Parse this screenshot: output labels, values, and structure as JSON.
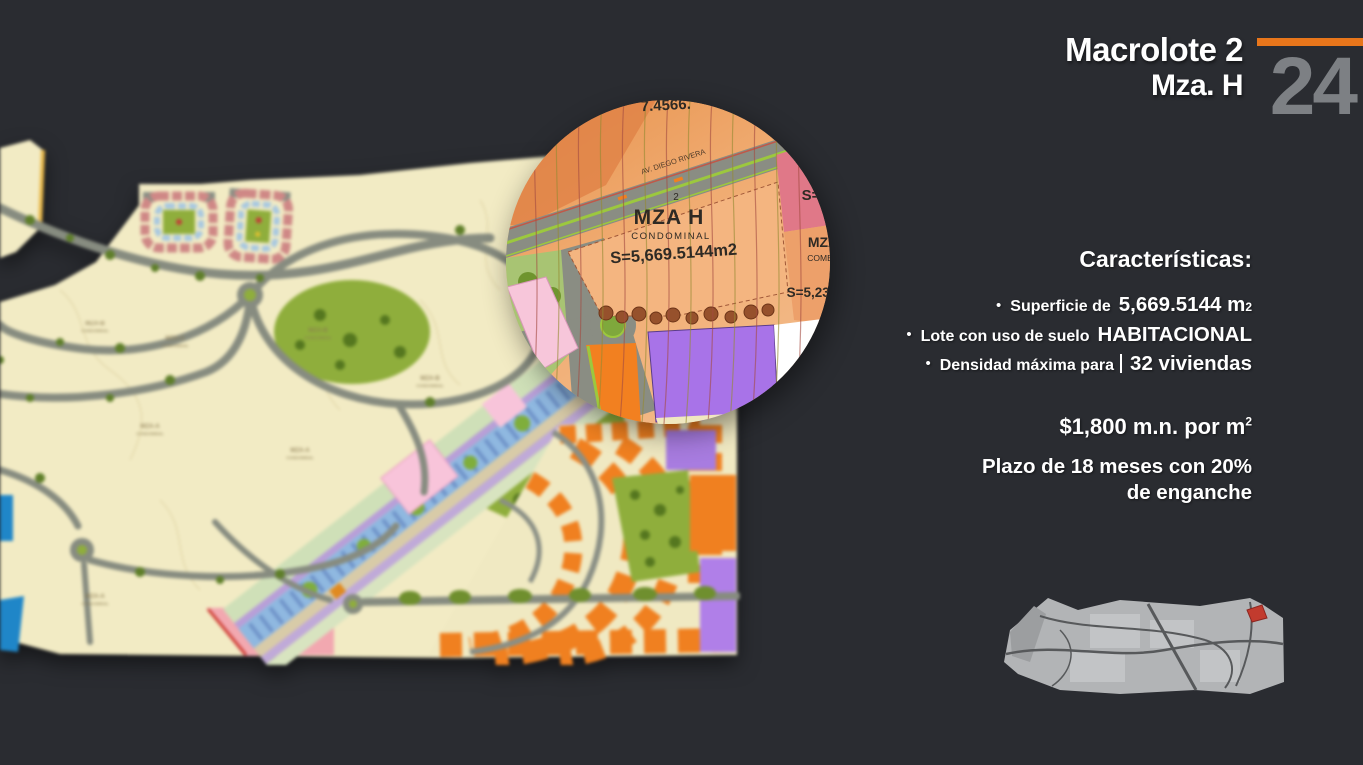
{
  "slide": {
    "background_color": "#2a2c31",
    "accent_color": "#e8761b",
    "page_number_color": "#7d8084",
    "title_line1": "Macrolote 2",
    "title_line2": "Mza. H",
    "page_number": "24"
  },
  "characteristics": {
    "heading": "Características:",
    "bullet_marker": "•",
    "bullets": [
      {
        "prefix": "Superficie de",
        "value": "5,669.5144 m",
        "value_sup": "2"
      },
      {
        "prefix": "Lote con uso de suelo",
        "value": "HABITACIONAL"
      },
      {
        "prefix": "Densidad máxima para",
        "value": "32 viviendas"
      }
    ]
  },
  "pricing": {
    "price": "$1,800 m.n. por m",
    "price_sup": "2",
    "terms_line1": "Plazo de 18 meses con 20%",
    "terms_line2": "de enganche"
  },
  "inset": {
    "top_fragment": "7.4566.",
    "street_label": "AV. DIEGO RIVERA",
    "lot_number": "2",
    "lot_name": "MZA H",
    "lot_type": "CONDOMINAL",
    "lot_area": "S=5,669.5144m2",
    "neighbor_area_partial": "S=",
    "neighbor_name_partial": "MZA",
    "neighbor_type_partial": "COME",
    "neighbor_area2_partial": "S=5,235"
  },
  "map": {
    "lot_label_a": "MZA-A",
    "lot_label_b": "MZA-B",
    "lot_label_c": "MZA-C",
    "lot_sublabel": "CONDOMINAL"
  }
}
